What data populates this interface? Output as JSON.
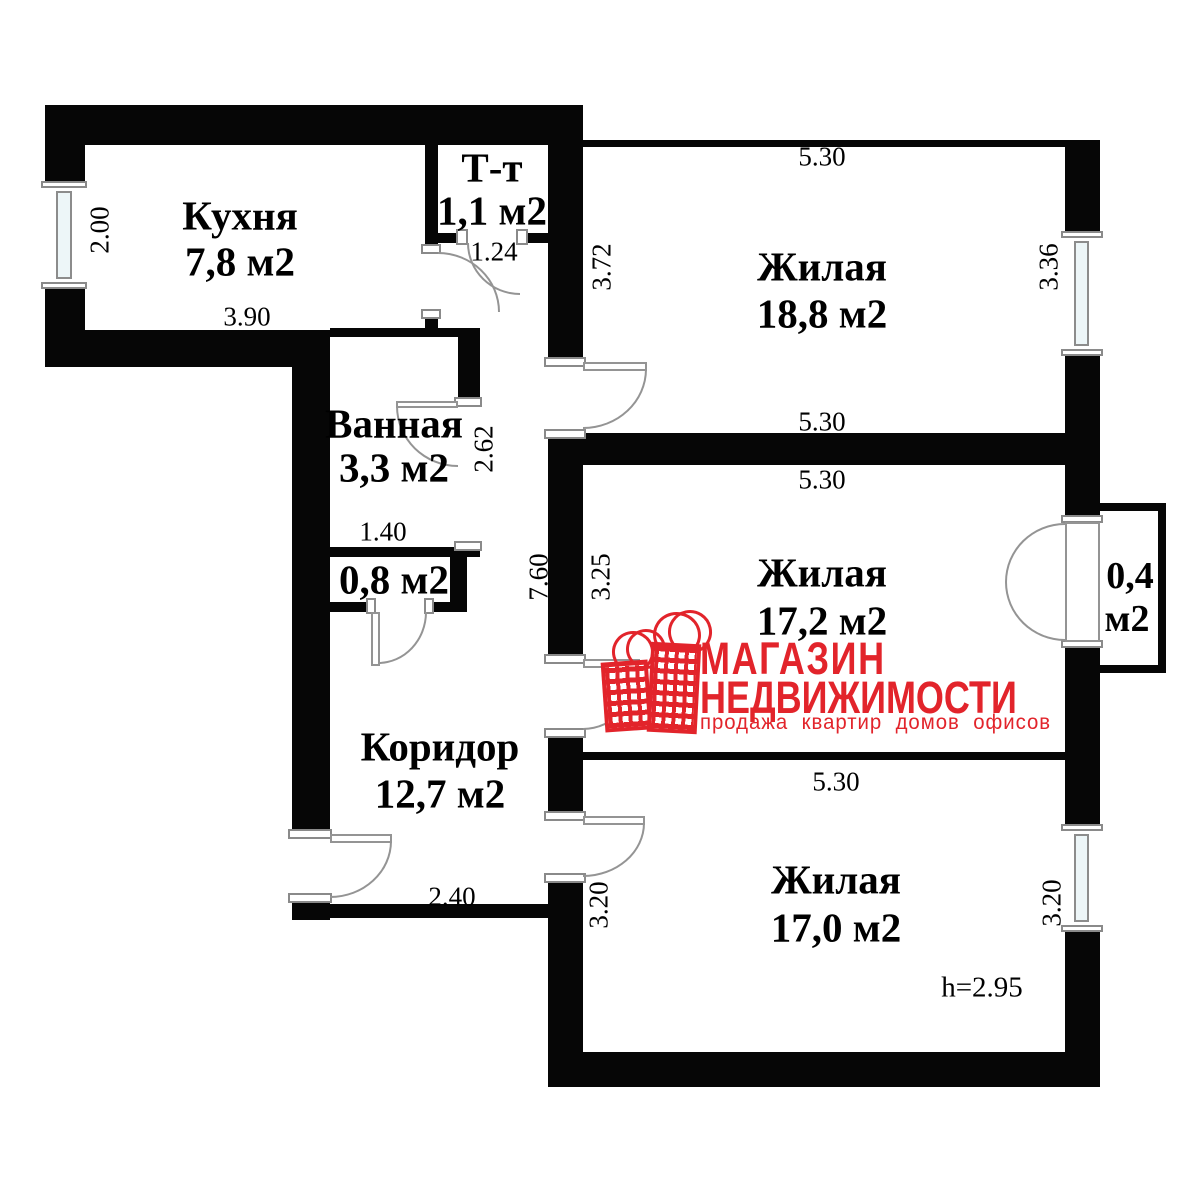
{
  "logo": {
    "line1": "МАГАЗИН",
    "line2": "НЕДВИЖИМОСТИ",
    "tagline": "продажа  квартир  домов  офисов",
    "brand_color": "#e2242b",
    "icon": "two-red-building-bags"
  },
  "ceiling_height_note": "h=2.95",
  "rooms": [
    {
      "name": "Кухня",
      "area": "7,8 м2"
    },
    {
      "name": "Т-т",
      "area": "1,1 м2"
    },
    {
      "name": "Ванная",
      "area": "3,3 м2"
    },
    {
      "name": "",
      "area": "0,8 м2"
    },
    {
      "name": "Коридор",
      "area": "12,7 м2"
    },
    {
      "name": "Жилая",
      "area": "18,8 м2"
    },
    {
      "name": "Жилая",
      "area": "17,2 м2"
    },
    {
      "name": "Жилая",
      "area": "17,0 м2"
    },
    {
      "name": "0,4",
      "area": "м2"
    }
  ],
  "dims": [
    {
      "v": "2.00"
    },
    {
      "v": "3.90"
    },
    {
      "v": "1.24"
    },
    {
      "v": "5.30"
    },
    {
      "v": "3.72"
    },
    {
      "v": "3.36"
    },
    {
      "v": "5.30"
    },
    {
      "v": "5.30"
    },
    {
      "v": "3.25"
    },
    {
      "v": "7.60"
    },
    {
      "v": "2.62"
    },
    {
      "v": "1.40"
    },
    {
      "v": "2.40"
    },
    {
      "v": "5.30"
    },
    {
      "v": "3.20"
    },
    {
      "v": "3.20"
    }
  ]
}
